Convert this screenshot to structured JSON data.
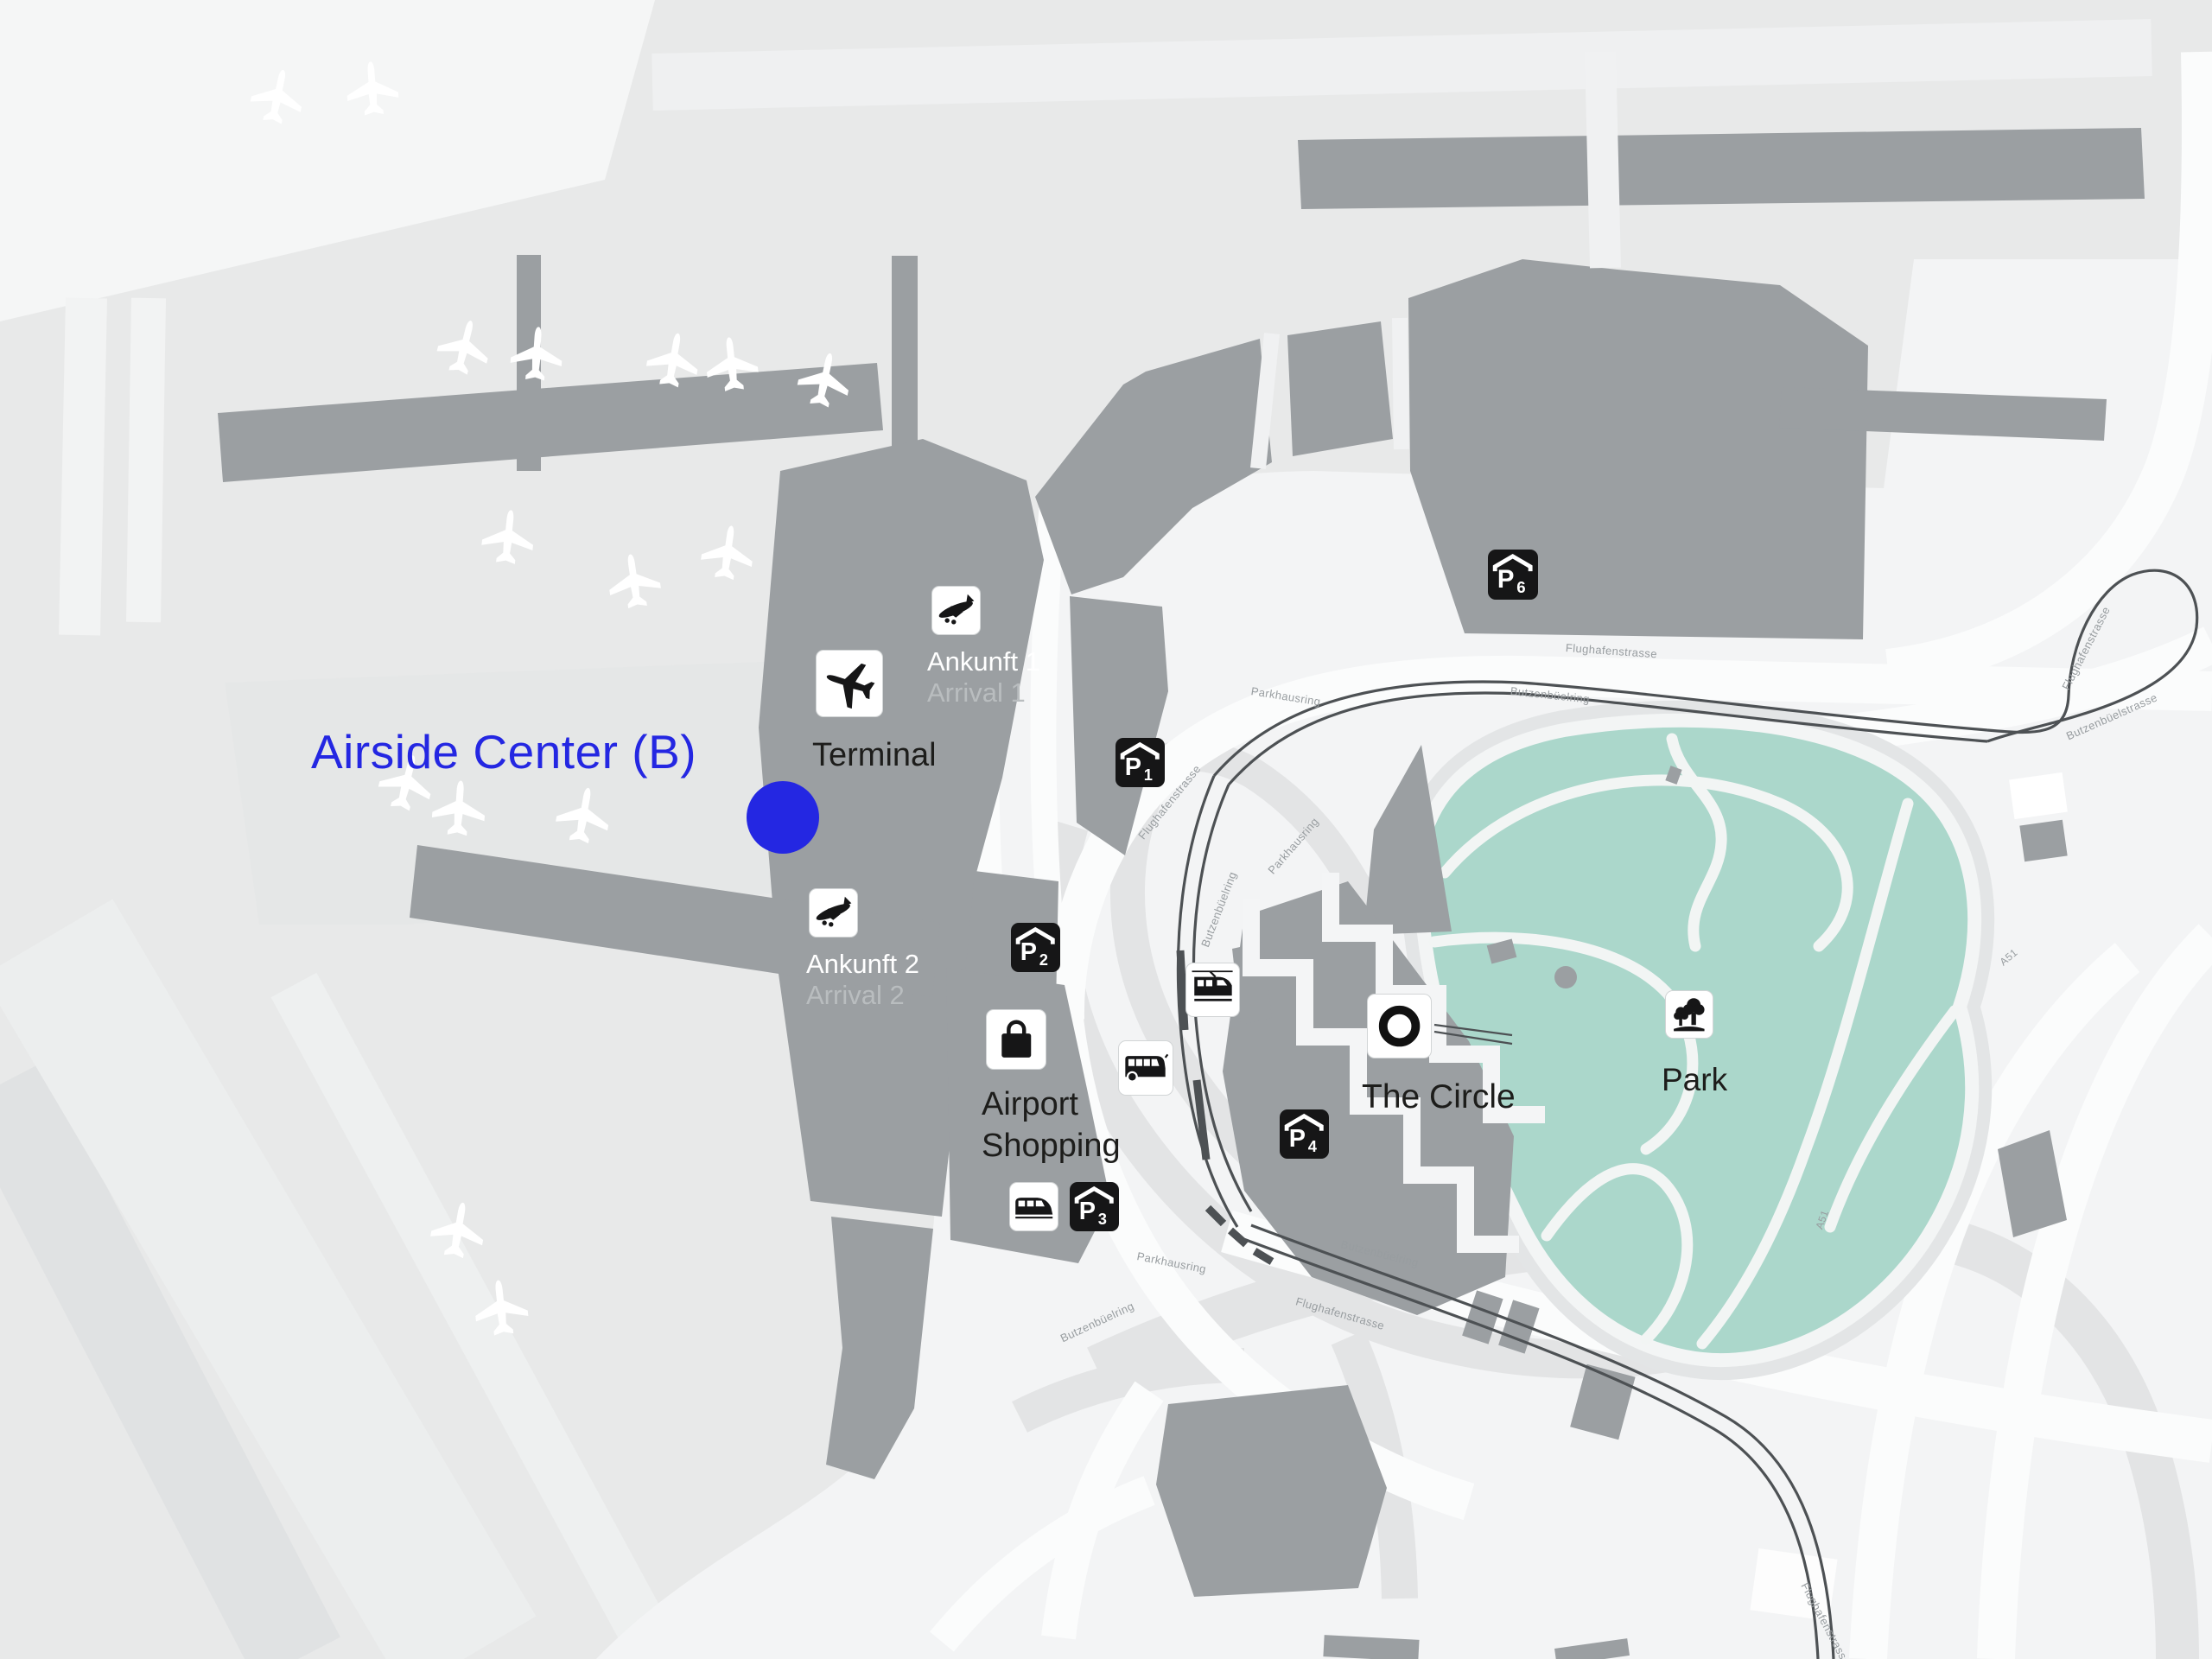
{
  "colors": {
    "accent_blue": "#2427e2",
    "building_gray": "#9b9fa2",
    "park_green": "#abd7cb",
    "background_gray": "#e8e9e9",
    "road_white": "#fbfcfc",
    "tram_line": "#4d5154"
  },
  "poi": {
    "airside_center": "Airside Center (B)",
    "terminal": "Terminal",
    "arrival1": {
      "de": "Ankunft 1",
      "en": "Arrival 1"
    },
    "arrival2": {
      "de": "Ankunft 2",
      "en": "Arrival 2"
    },
    "shopping": {
      "line1": "Airport",
      "line2": "Shopping"
    },
    "the_circle": "The Circle",
    "park": "Park"
  },
  "parking": [
    {
      "letter": "P",
      "num": "1"
    },
    {
      "letter": "P",
      "num": "2"
    },
    {
      "letter": "P",
      "num": "3"
    },
    {
      "letter": "P",
      "num": "4"
    },
    {
      "letter": "P",
      "num": "6"
    }
  ],
  "icon_names": [
    "airplane-icon",
    "arrival-plane-icon",
    "covered-parking-icon",
    "shopping-bag-icon",
    "train-icon",
    "bus-icon",
    "tram-icon",
    "circle-ring-icon",
    "park-trees-icon",
    "location-dot"
  ],
  "streets": [
    {
      "text": "Flughafenstrasse"
    },
    {
      "text": "Butzenbüelring"
    },
    {
      "text": "Parkhausring"
    },
    {
      "text": "Flughafenstrasse"
    },
    {
      "text": "Parkhausring"
    },
    {
      "text": "Butzenbüelring"
    },
    {
      "text": "Parkhausring"
    },
    {
      "text": "Butzenbüelring"
    },
    {
      "text": "Flughafenstrasse"
    },
    {
      "text": "Butzenbüelring"
    },
    {
      "text": "Flughafenstrasse"
    },
    {
      "text": "Butzenbüelstrasse"
    },
    {
      "text": "A51"
    },
    {
      "text": "A51"
    },
    {
      "text": "Flughafenstrasse"
    }
  ]
}
